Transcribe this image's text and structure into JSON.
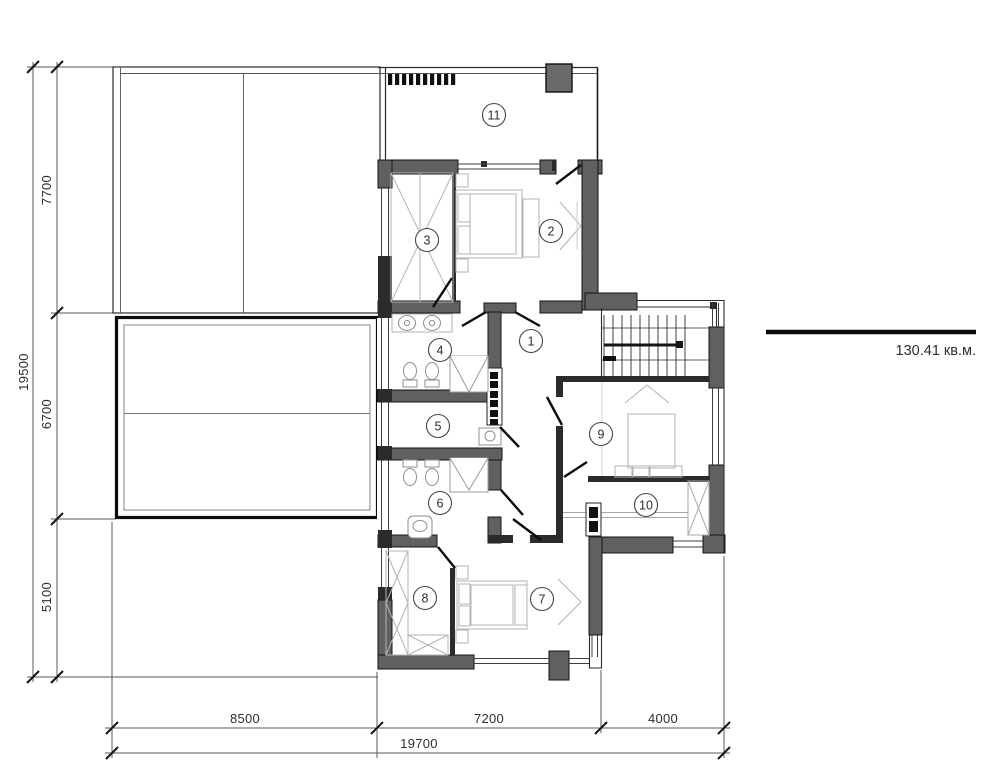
{
  "rooms": [
    "1",
    "2",
    "3",
    "4",
    "5",
    "6",
    "7",
    "8",
    "9",
    "10",
    "11"
  ],
  "dims": {
    "left_total": "19500",
    "left_segments": [
      "7700",
      "6700",
      "5100"
    ],
    "bottom_segments": [
      "8500",
      "7200",
      "4000"
    ],
    "bottom_total": "19700"
  },
  "annotation": {
    "area": "130.41 кв.м."
  },
  "colors": {
    "wall": "#606060",
    "partition": "#2b2b2b",
    "line": "#2e2e2e"
  }
}
